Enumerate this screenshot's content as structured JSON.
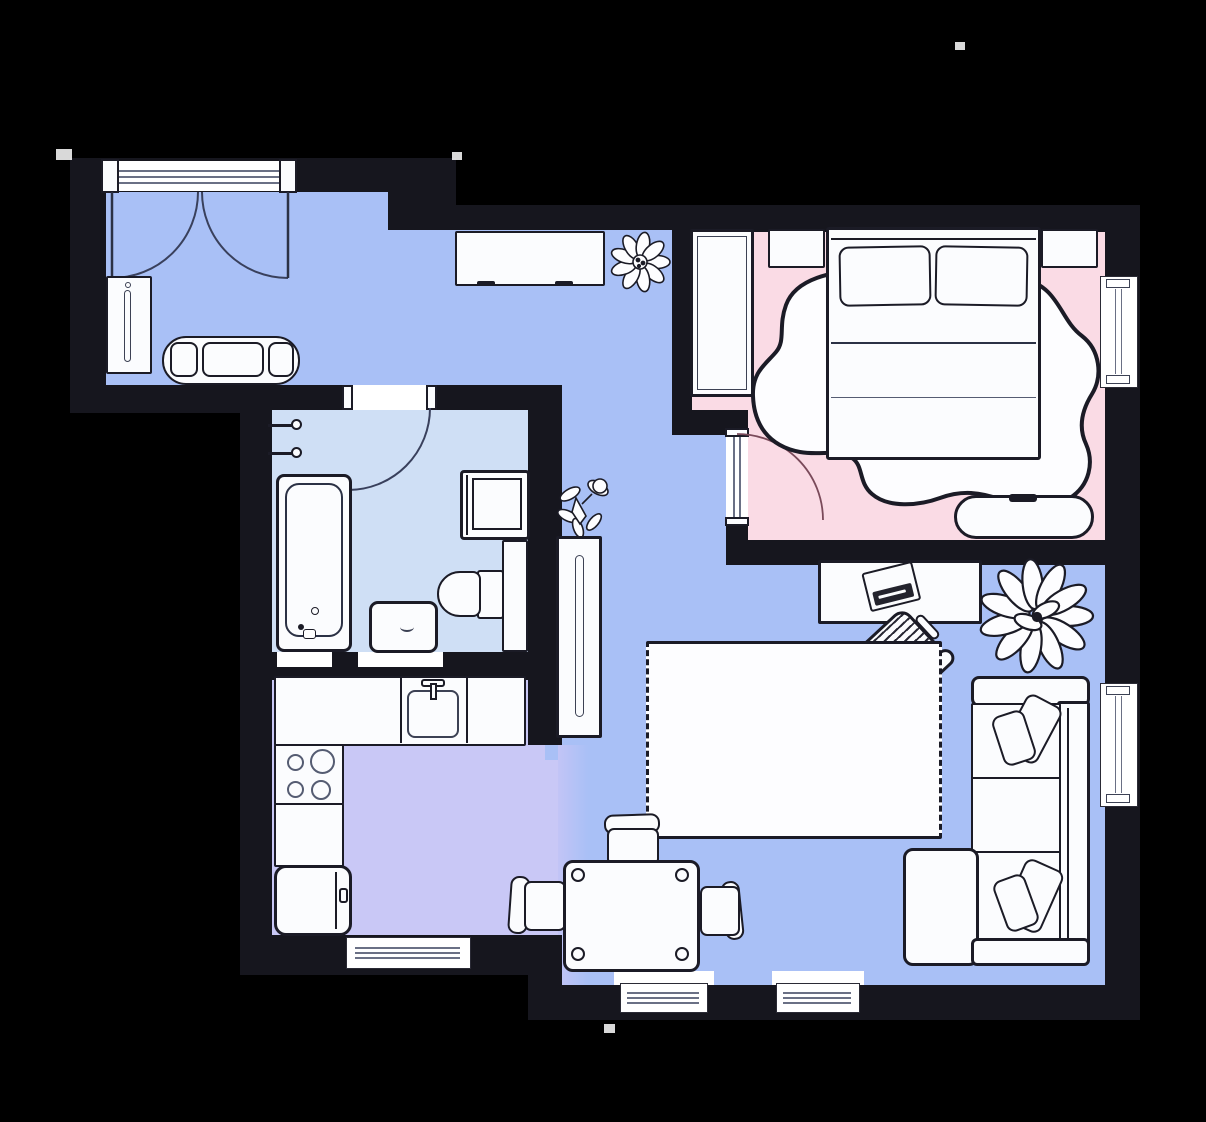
{
  "meta": {
    "kind": "apartment-floor-plan",
    "style": "top-down illustrated plan, no visible text"
  },
  "palette": {
    "background": "#000000",
    "wall": "#16161e",
    "outline": "#1b1b26",
    "soft_line": "#6a7085",
    "arc_line": "#39405c",
    "furniture_fill": "#fbfcfe",
    "hall_floor": "#a9c0f6",
    "bedroom_floor": "#fadbe5",
    "bathroom_floor": "#cfdff5",
    "kitchen_floor": "#c9c8f6",
    "living_floor": "#a9c0f6",
    "dark_fill": "#23232d"
  },
  "rooms": [
    {
      "id": "entry-hall",
      "name": "Entry hall with corridor",
      "floor_color_key": "hall_floor"
    },
    {
      "id": "bedroom",
      "name": "Bedroom",
      "floor_color_key": "bedroom_floor"
    },
    {
      "id": "bathroom",
      "name": "Bathroom",
      "floor_color_key": "bathroom_floor"
    },
    {
      "id": "kitchen",
      "name": "Kitchen",
      "floor_color_key": "kitchen_floor"
    },
    {
      "id": "living-room",
      "name": "Living room",
      "floor_color_key": "living_floor"
    }
  ],
  "furniture": {
    "entry_hall": [
      "double-entry-door",
      "mirror-cabinet",
      "shoe-bench",
      "sideboard",
      "flower-plant",
      "small-plant"
    ],
    "bedroom": [
      "wardrobe",
      "nightstand-left",
      "nightstand-right",
      "double-bed",
      "organic-rug",
      "ottoman-bench"
    ],
    "bathroom": [
      "towel-hooks",
      "bathtub",
      "washing-machine",
      "toilet",
      "side-cabinet",
      "sink-vanity"
    ],
    "kitchen": [
      "sink-counter",
      "stove-counter",
      "lower-counter",
      "fridge"
    ],
    "living_room": [
      "bookcase",
      "desk",
      "laptop",
      "office-chair",
      "large-plant",
      "fringed-rug",
      "dining-table",
      "dining-chairs",
      "corner-sofa",
      "sofa-pillows"
    ]
  },
  "openings": {
    "doors": [
      "entry-double-door-top",
      "bathroom-door-top",
      "bedroom-door-left"
    ],
    "windows": [
      "bedroom-window-right",
      "living-window-right",
      "kitchen-window-bottom",
      "living-window-bottom-1",
      "living-window-bottom-2"
    ]
  }
}
